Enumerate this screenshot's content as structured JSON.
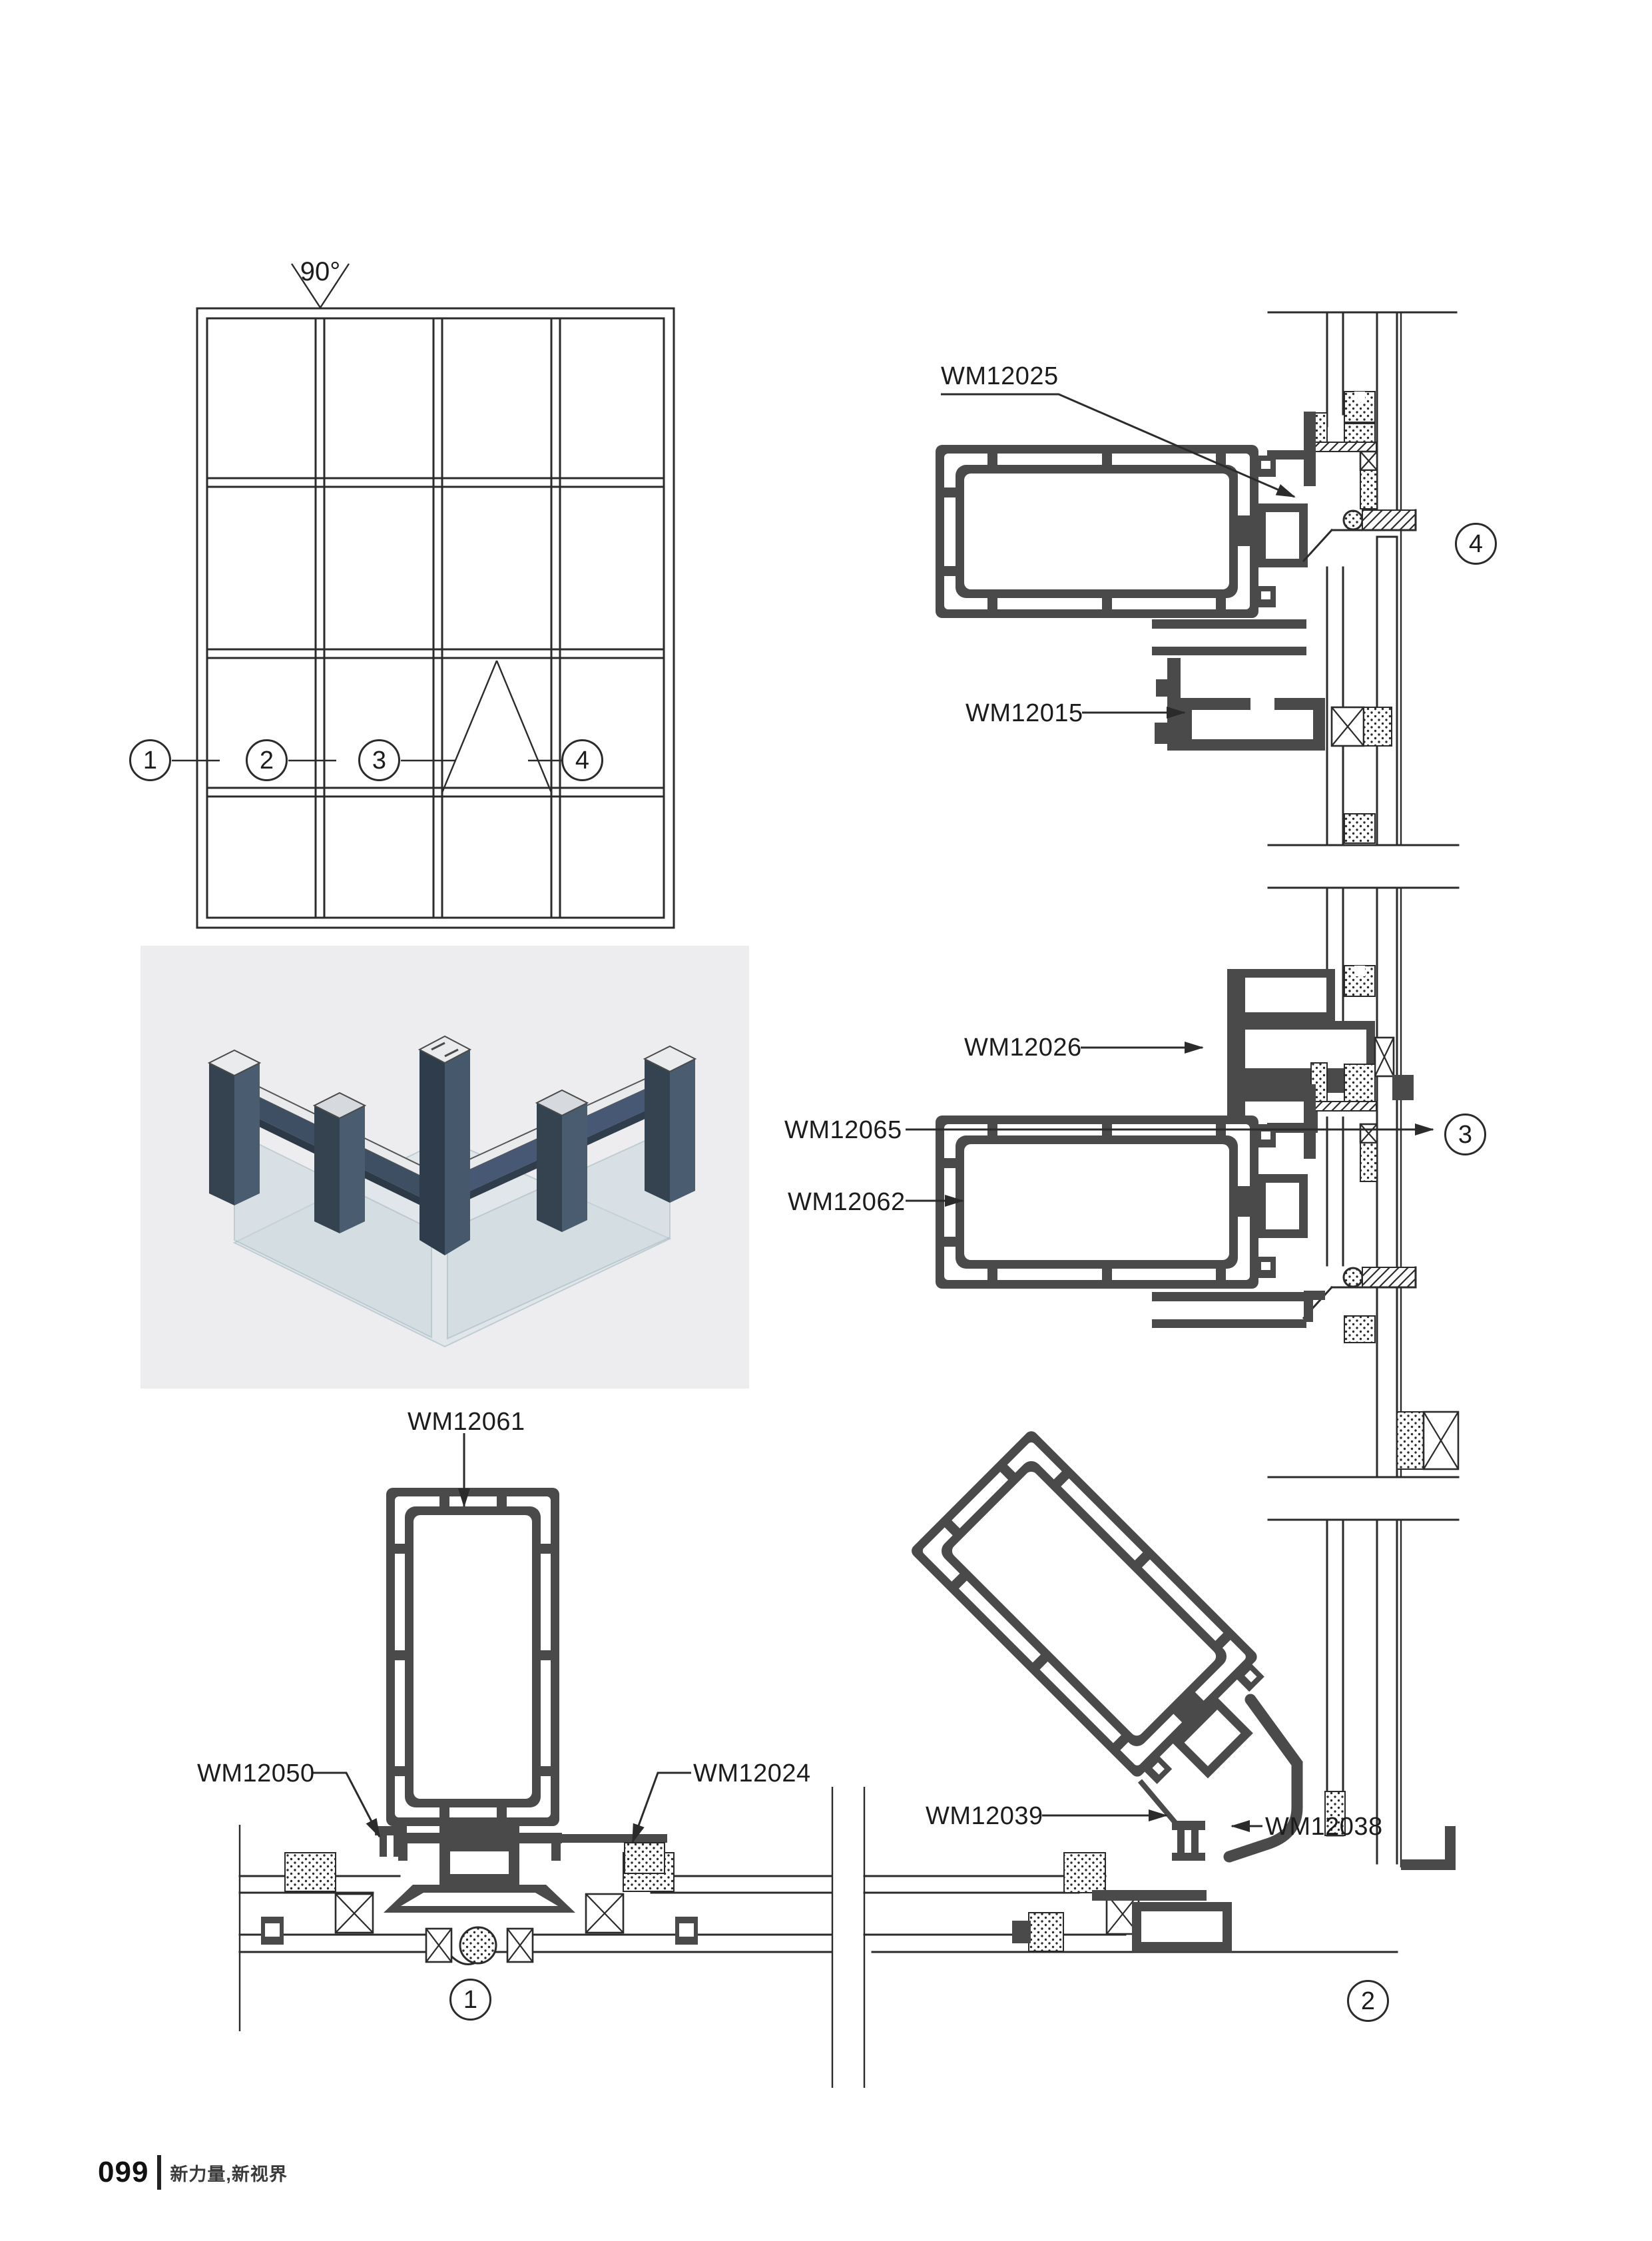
{
  "colors": {
    "line": "#2b2b2b",
    "profile": "#4a4a4a",
    "render_bg": "#ededef",
    "render_profile_dark": "#35424f",
    "render_profile_light": "#4a5c70",
    "render_glass": "#cdd9e0"
  },
  "elevation": {
    "angle": "90°"
  },
  "parts": {
    "wm12025": "WM12025",
    "wm12015": "WM12015",
    "wm12026": "WM12026",
    "wm12065": "WM12065",
    "wm12062": "WM12062",
    "wm12061": "WM12061",
    "wm12050": "WM12050",
    "wm12024": "WM12024",
    "wm12039": "WM12039",
    "wm12038": "WM12038"
  },
  "callouts": {
    "c1": "1",
    "c2": "2",
    "c3": "3",
    "c4": "4"
  },
  "footer": {
    "page_number": "099",
    "tagline": "新力量,新视界"
  }
}
